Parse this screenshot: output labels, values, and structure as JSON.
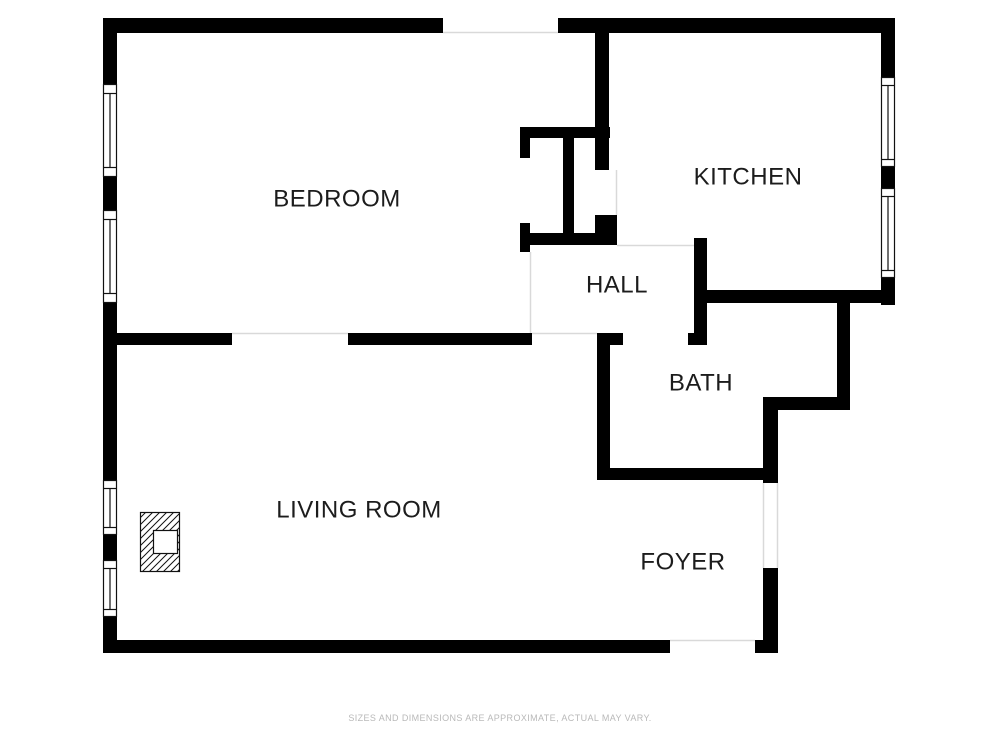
{
  "plan": {
    "title": "one-bedroom apartment floor plan",
    "rooms": [
      {
        "name": "bedroom",
        "label": "BEDROOM"
      },
      {
        "name": "kitchen",
        "label": "KITCHEN"
      },
      {
        "name": "hall",
        "label": "HALL"
      },
      {
        "name": "bath",
        "label": "BATH"
      },
      {
        "name": "living-room",
        "label": "LIVING ROOM"
      },
      {
        "name": "foyer",
        "label": "FOYER"
      }
    ],
    "symbols": [
      {
        "name": "window-symbol",
        "count": 6
      },
      {
        "name": "fireplace-symbol",
        "count": 1
      }
    ],
    "colors": {
      "wall": "#000000",
      "label": "#1c1c1c",
      "opening_line": "#d9d9d9",
      "disclaimer": "#b9b9b9",
      "background": "#ffffff"
    },
    "disclaimer": "SIZES AND DIMENSIONS ARE APPROXIMATE, ACTUAL MAY VARY."
  }
}
